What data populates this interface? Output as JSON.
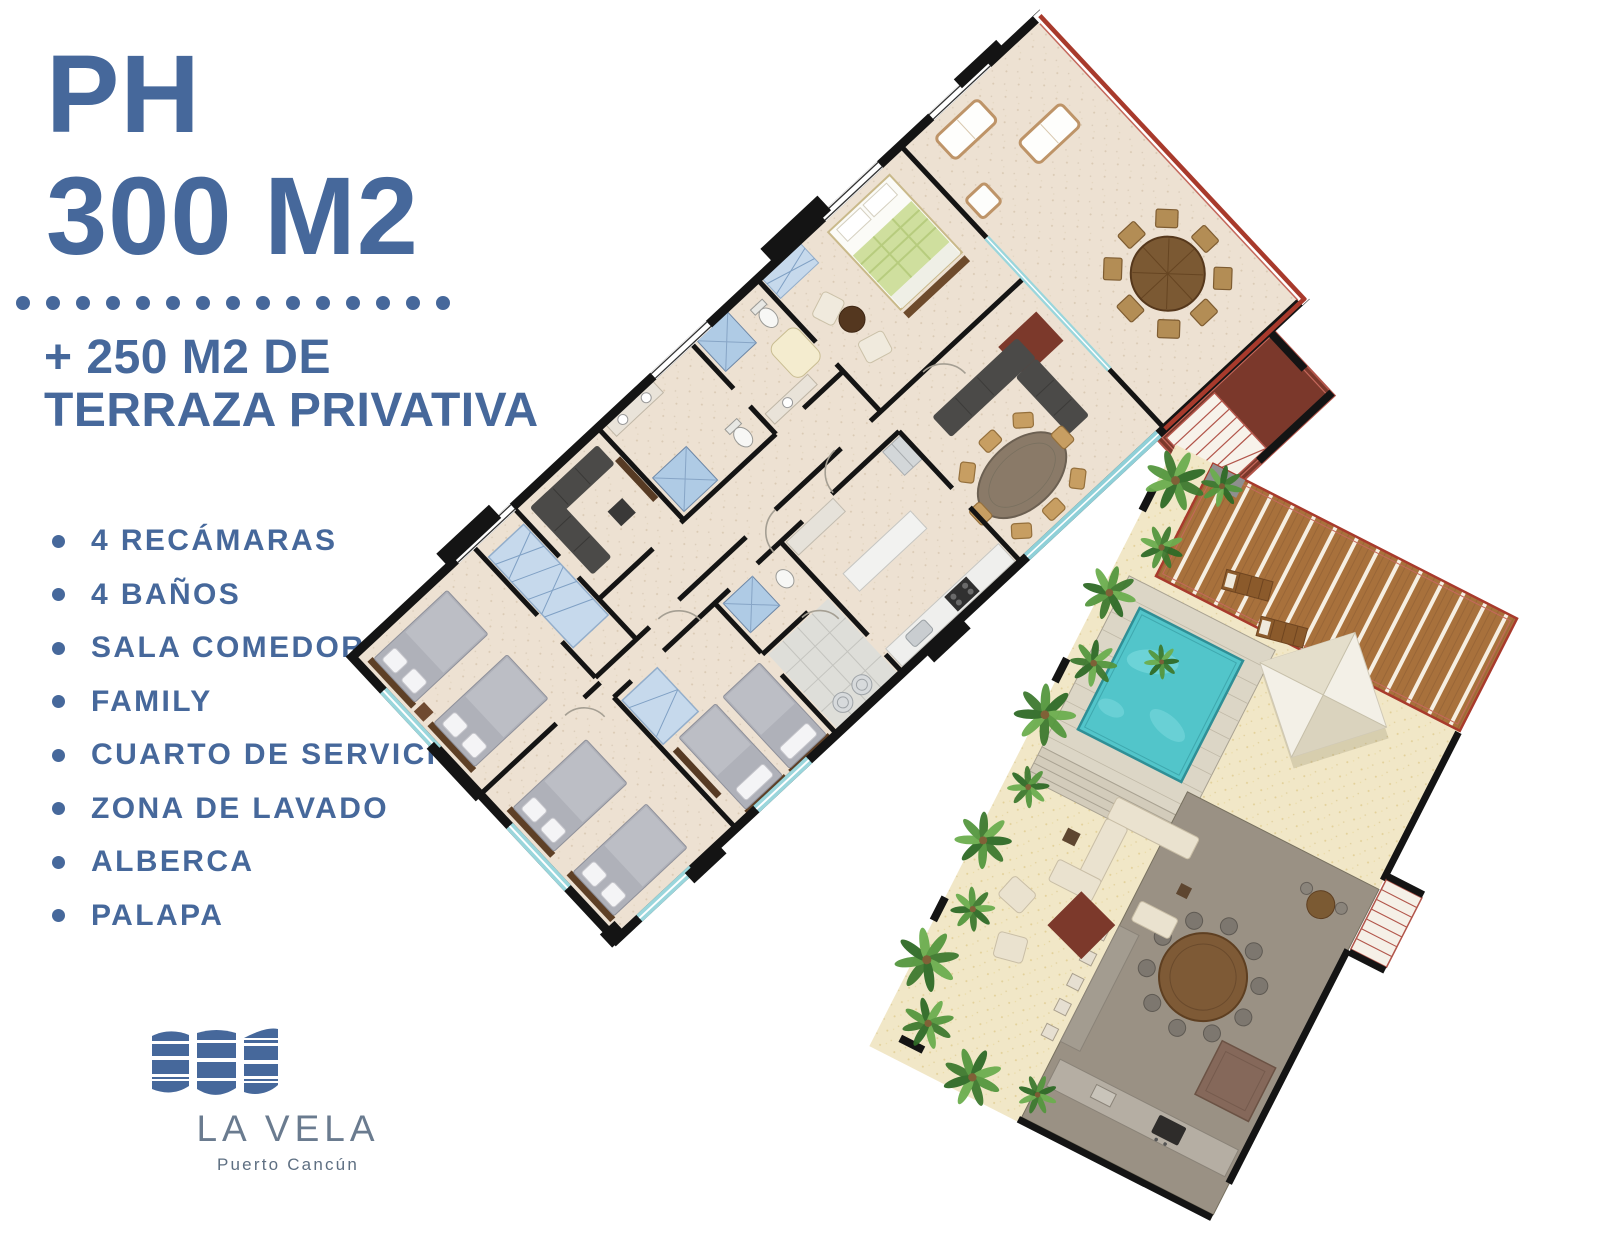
{
  "header": {
    "line1": "PH",
    "line2": "300 M2"
  },
  "separator": {
    "dot_count": 15
  },
  "subtitle": {
    "line1": "+ 250 M2 DE",
    "line2": "TERRAZA PRIVATIVA"
  },
  "features": {
    "items": [
      "4 RECÁMARAS",
      "4 BAÑOS",
      "SALA COMEDOR",
      "FAMILY",
      "CUARTO DE SERVICIO",
      "ZONA DE LAVADO",
      "ALBERCA",
      "PALAPA"
    ]
  },
  "logo": {
    "name": "LA VELA",
    "subtitle": "Puerto Cancún"
  },
  "colors": {
    "accent_blue": "#46689B",
    "logo_gray_blue": "#6A7B8F",
    "terrace_red": "#A83A2C",
    "pool_turquoise": "#52C5CA",
    "floor_beige": "#EDE1D2",
    "sand": "#F1E7C7",
    "wall_black": "#141414",
    "deck_taupe": "#9A9184",
    "rug_maroon": "#7C392B",
    "palm_green": "#55973F"
  }
}
